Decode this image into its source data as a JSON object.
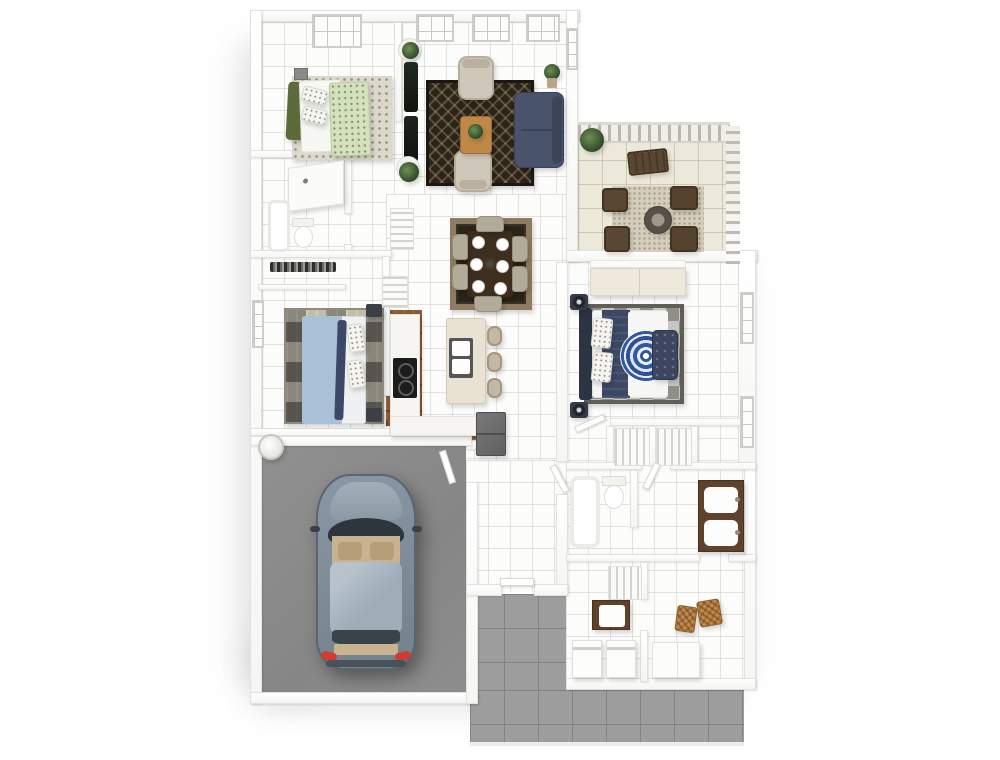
{
  "title": "3D rendered residential floor plan, top-down view",
  "colors": {
    "tile": "#fcfcfb",
    "patio": "#ece8da",
    "drive": "#9d9d9d",
    "garage": "#8a8a8a",
    "wood": "#8b5a33",
    "rug_dark": "#2b2419",
    "rug_border_tan": "#8d7c62",
    "sofa_navy": "#49536b",
    "armchair_beige": "#cfc8ba",
    "table_wood": "#c08848",
    "dining_table": "#3e2e1e",
    "chair_beige": "#b3ab9a",
    "island_cream": "#e9e2d2",
    "counter_white": "#f6f5f1",
    "cooktop_black": "#1c1c1c",
    "fridge_gray": "#6e6e6e",
    "duvet_green": "#d5e0bd",
    "throw_olive": "#5c6b3a",
    "duvet_blue": "#a9c0d6",
    "navy_dark": "#3c4866",
    "mandala_blue": "#34589e",
    "bench_navy": "#3d4560",
    "car_body": "#7f8d9a",
    "car_glass": "#aebac4",
    "car_interior": "#c8b28f",
    "taillight_red": "#d23b2f",
    "vanity_wood": "#5f422c",
    "basket": "#c08a4e",
    "fence": "#efeee8",
    "firepit_ring": "#57514a"
  },
  "rooms": [
    {
      "id": "bedroom-1",
      "items": [
        "bed-green-floral-duvet",
        "white-speckled-pillows",
        "olive-throw",
        "speckled-rug",
        "top-wall-window",
        "headboard-cabinet"
      ]
    },
    {
      "id": "living-room",
      "items": [
        "navy-sofa",
        "beige-armchair-top",
        "beige-armchair-bottom",
        "wood-coffee-table-with-plant",
        "dark-diamond-rug",
        "curtain-panels",
        "potted-plants",
        "three-top-windows",
        "corner-plant"
      ]
    },
    {
      "id": "patio",
      "items": [
        "railing-top",
        "railing-right",
        "gravel-rug",
        "fire-pit",
        "four-dark-wood-chairs",
        "wood-bench",
        "potted-plant"
      ]
    },
    {
      "id": "dining-area",
      "items": [
        "layered-rug",
        "dark-wood-table",
        "six-white-place-settings",
        "six-beige-chairs",
        "chandelier"
      ]
    },
    {
      "id": "kitchen",
      "items": [
        "l-shaped-wood-floor",
        "left-counter",
        "cooktop",
        "cream-island-with-sink",
        "three-bar-stools",
        "refrigerator",
        "bottom-counter"
      ]
    },
    {
      "id": "bedroom-2",
      "items": [
        "light-blue-bed",
        "plaid-rug",
        "closet-with-hanging-rod",
        "two-nightstands",
        "left-wall-window"
      ]
    },
    {
      "id": "hall-bathroom",
      "items": [
        "vanity-counter",
        "toilet",
        "bathtub"
      ]
    },
    {
      "id": "hallway",
      "items": [
        "linen-shelves-upper",
        "linen-shelves-lower"
      ]
    },
    {
      "id": "master-bedroom",
      "items": [
        "navy-and-white-bed-with-mandala-duvet",
        "dark-headboard",
        "checkered-rug",
        "tufted-navy-bench",
        "two-nightstand-lamps",
        "built-in-wardrobe",
        "right-wall-windows"
      ]
    },
    {
      "id": "master-closets",
      "items": [
        "shelving-unit-left",
        "shelving-unit-right"
      ]
    },
    {
      "id": "master-bathroom",
      "items": [
        "bathtub",
        "toilet",
        "double-sink-vanity"
      ]
    },
    {
      "id": "lower-closet",
      "items": [
        "shelving-unit"
      ]
    },
    {
      "id": "laundry-room",
      "items": [
        "utility-sink-cabinet",
        "washer",
        "dryer"
      ]
    },
    {
      "id": "mudroom",
      "items": [
        "wicker-basket-left",
        "wicker-basket-right",
        "white-cabinet"
      ]
    },
    {
      "id": "garage",
      "items": [
        "car-top-view",
        "water-heater",
        "entry-door"
      ]
    },
    {
      "id": "exterior",
      "items": [
        "front-porch",
        "driveway",
        "building-shadow"
      ]
    }
  ]
}
